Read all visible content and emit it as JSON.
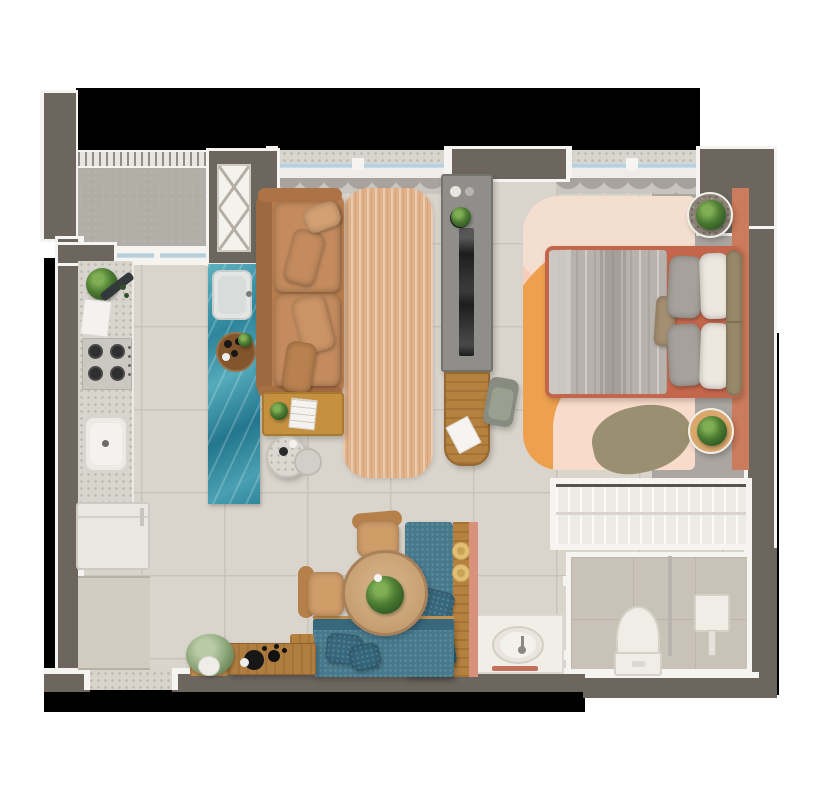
{
  "meta": {
    "kind": "apartment-floor-plan-render",
    "view": "top-down",
    "width_px": 817,
    "height_px": 792,
    "visible_text": "none"
  },
  "palette": {
    "void": "#000000",
    "wall": "#6c665f",
    "trim": "#f6f4f0",
    "floorTile": "#d9d4cc",
    "grout": "#c9c3bb",
    "balconyFloor": "#b1ada7",
    "speckDot": "#bab4ab",
    "terr": "#d8d5cf",
    "glazing": "#b5cedb",
    "curtainA": "#c9c5bf",
    "curtainB": "#a5a19b",
    "teal1": "#5db2c1",
    "teal2": "#2e869c",
    "teal3": "#23768d",
    "jute": "#e2b38b",
    "leather": "#b67c4e",
    "leatherDark": "#9e6840",
    "leatherCushion": "#c38b5e",
    "mustard": "#c59140",
    "trayWood": "#82552c",
    "tvUnit": "#8f8e8a",
    "tvEdge": "#74736d",
    "tvScreen": "#1d1d1d",
    "oak": "#b5813f",
    "chairSage": "#878b80",
    "bedFrame": "#c3664c",
    "duvet": "#b7b2ac",
    "sheet": "#cfcac4",
    "pillowGray": "#a7a19b",
    "pillowWhite": "#ece7df",
    "headboard": "#97886a",
    "tanPad": "#a58f72",
    "rugBlush": "#f5cdbc",
    "rugCream": "#f3decf",
    "rugOrange": "#eda04e",
    "rugPink": "#f8dbcb",
    "runner": "#cc7b5c",
    "olive": "#9a9071",
    "grayMargin": "#aba6a0",
    "gravel": "#8a8275",
    "nightWood": "#daa76c",
    "closetBg": "#edebe5",
    "closetLine": "#fbfaf7",
    "closetRod": "#d9d5ce",
    "closetBack": "#57534d",
    "bathFloor": "#c9c2b6",
    "bathLine": "#bcb5a8",
    "porcelain": "#f0ede7",
    "porcelainEdge": "#d6d1c9",
    "glassPart": "#b8b3ac",
    "tealSofa": "#47798d",
    "tealSofaDeep": "#38687d",
    "tableWood": "#c7a173",
    "tableEdge": "#a8815a",
    "chairWood": "#b5804a",
    "chairPad": "#d09d69",
    "hat": "#e2bd74",
    "hatDot": "#c7a257",
    "sideboard": "#b07d40",
    "salmon": "#d8917b",
    "plantD": "#2f5a22",
    "plantM": "#4d7c33",
    "plantL": "#7fae54",
    "paleL": "#b9cba6",
    "paleM": "#8aa477",
    "threshold": "#d8d4cb",
    "entryMat": "#d3ccc0"
  },
  "rooms": {
    "balcony": {
      "features": [
        "railing",
        "terrazzo-sill",
        "sliding-glass-door",
        "ac-unit-niche"
      ]
    },
    "kitchen": {
      "features": [
        "terrazzo-counter",
        "4-burner-cooktop",
        "kitchen-sink",
        "refrigerator",
        "teal-marble-island",
        "island-sink",
        "coffee-tray",
        "herb-plant",
        "cutting-board",
        "towels"
      ]
    },
    "living": {
      "features": [
        "leather-sofa",
        "throw-pillows",
        "jute-rug",
        "mustard-coffee-table",
        "book",
        "nesting-side-tables",
        "tv-partition",
        "tv",
        "wall-desk",
        "desk-chair",
        "window-curtains"
      ]
    },
    "bedroom": {
      "features": [
        "double-bed",
        "terracotta-bed-frame",
        "gray-duvet",
        "gray-pillows",
        "white-pillows",
        "bolster-headboard",
        "color-block-rug",
        "terracotta-runner",
        "olive-accent-rug",
        "round-nightstand-top",
        "round-nightstand-bottom",
        "potted-plants",
        "window-curtain"
      ]
    },
    "dining": {
      "features": [
        "round-wood-table",
        "centerpiece-plant",
        "two-bentwood-chairs",
        "l-shaped-teal-banquette",
        "banquette-cushions",
        "oak-back-panel",
        "straw-hats"
      ]
    },
    "entry": {
      "features": [
        "wood-sideboard",
        "decor-tray",
        "floor-plant",
        "door-threshold",
        "entry-mat"
      ]
    },
    "closet": {
      "features": [
        "wardrobe-with-hangers",
        "hanging-rod"
      ]
    },
    "bathroom": {
      "features": [
        "toilet",
        "glass-shower-partition",
        "shower-column",
        "vanity-counter",
        "oval-sink",
        "faucet",
        "terracotta-towel"
      ]
    }
  }
}
